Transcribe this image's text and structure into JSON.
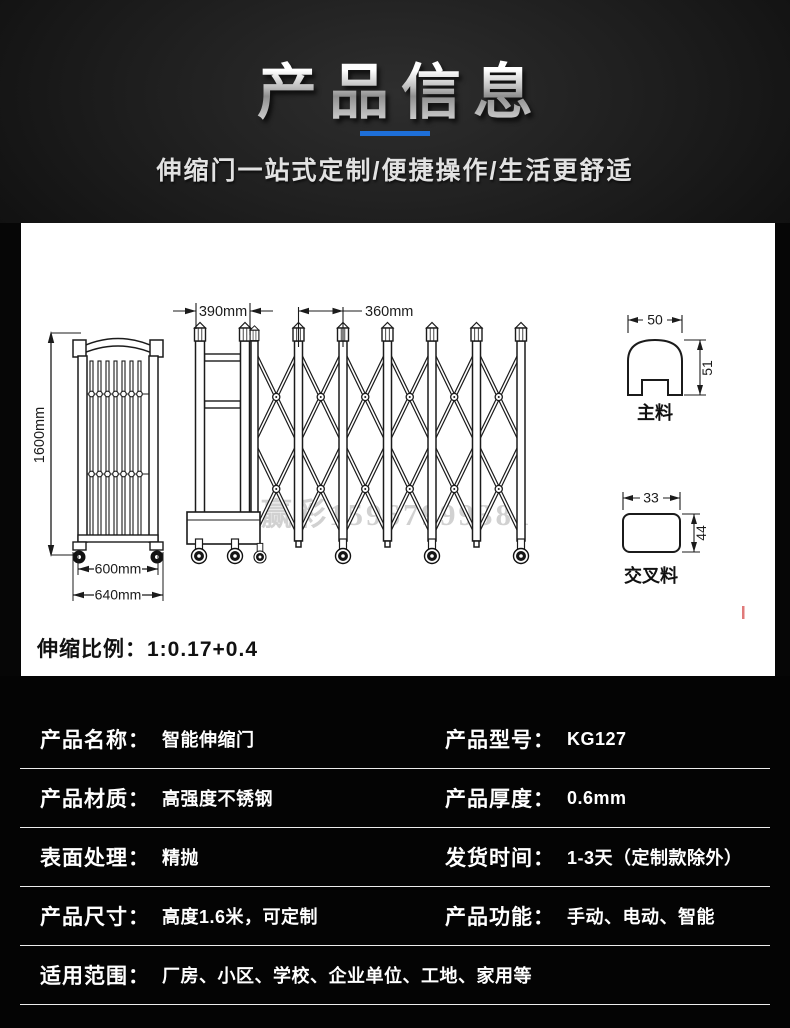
{
  "header": {
    "title": "产品信息",
    "subtitle": "伸缩门一站式定制/便捷操作/生活更舒适"
  },
  "colors": {
    "accent_blue": "#1e6fd8",
    "red_mark": "#e07a7a",
    "panel_bg": "#ffffff",
    "page_bg": "#060606"
  },
  "drawing": {
    "height_dim": "1600mm",
    "inner_width_dim": "600mm",
    "outer_width_dim": "640mm",
    "lead_width_dim": "390mm",
    "section_width_dim": "360mm",
    "main_profile_width": "50",
    "main_profile_height": "51",
    "main_profile_label": "主料",
    "cross_profile_width": "33",
    "cross_profile_height": "44",
    "cross_profile_label": "交叉料",
    "scale_note": "伸缩比例：1:0.17+0.4",
    "watermark": "赢彩15967999381"
  },
  "specs": {
    "rows": [
      {
        "label": "产品名称：",
        "value": "智能伸缩门",
        "label2": "产品型号：",
        "value2": "KG127"
      },
      {
        "label": "产品材质：",
        "value": "高强度不锈钢",
        "label2": "产品厚度：",
        "value2": "0.6mm"
      },
      {
        "label": "表面处理：",
        "value": "精抛",
        "label2": "发货时间：",
        "value2": "1-3天（定制款除外）"
      },
      {
        "label": "产品尺寸：",
        "value": "高度1.6米，可定制",
        "label2": "产品功能：",
        "value2": "手动、电动、智能"
      },
      {
        "label": "适用范围：",
        "value": "厂房、小区、学校、企业单位、工地、家用等",
        "label2": "",
        "value2": ""
      }
    ]
  }
}
